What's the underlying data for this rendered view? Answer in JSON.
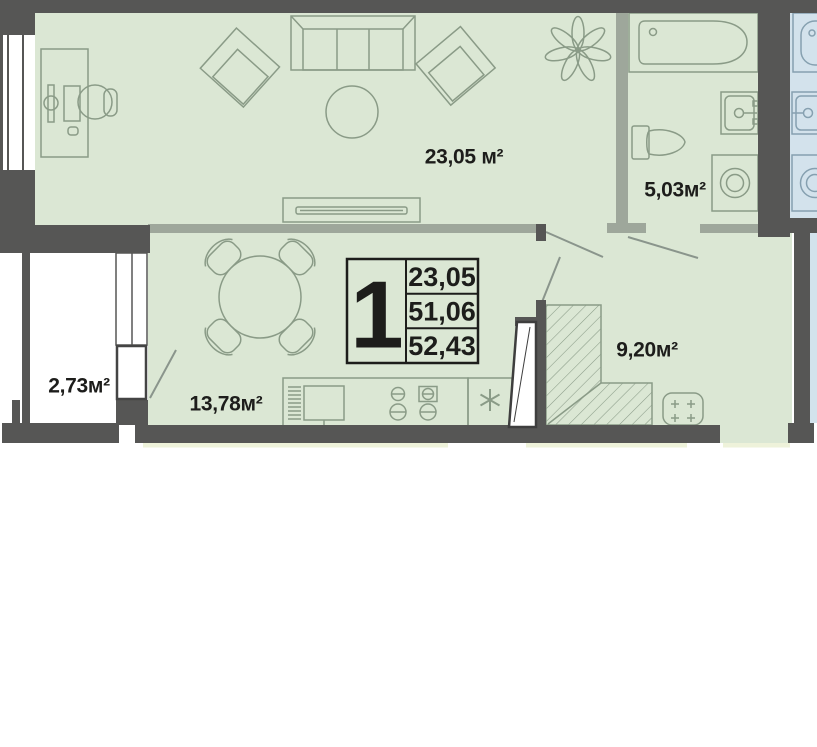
{
  "floorplan": {
    "summary_box": {
      "rooms_count": "1",
      "rows": [
        "23,05",
        "51,06",
        "52,43"
      ]
    },
    "rooms": [
      {
        "id": "living-room",
        "area": "23,05 м²"
      },
      {
        "id": "bathroom",
        "area": "5,03м²"
      },
      {
        "id": "balcony",
        "area": "2,73м²"
      },
      {
        "id": "kitchen",
        "area": "13,78м²"
      },
      {
        "id": "hallway",
        "area": "9,20м²"
      }
    ],
    "colors": {
      "wall": "#565655",
      "partition": "#9ea79b",
      "room_fill": "#dbe7d4",
      "neighbor_fill": "#d3e2ec",
      "neighbor_stroke": "#86a0b0",
      "furniture_stroke": "#8a9b87",
      "label_text": "#1d1d1b",
      "floor_strip": "#eef2da",
      "door_swing": "#8a958c"
    }
  }
}
